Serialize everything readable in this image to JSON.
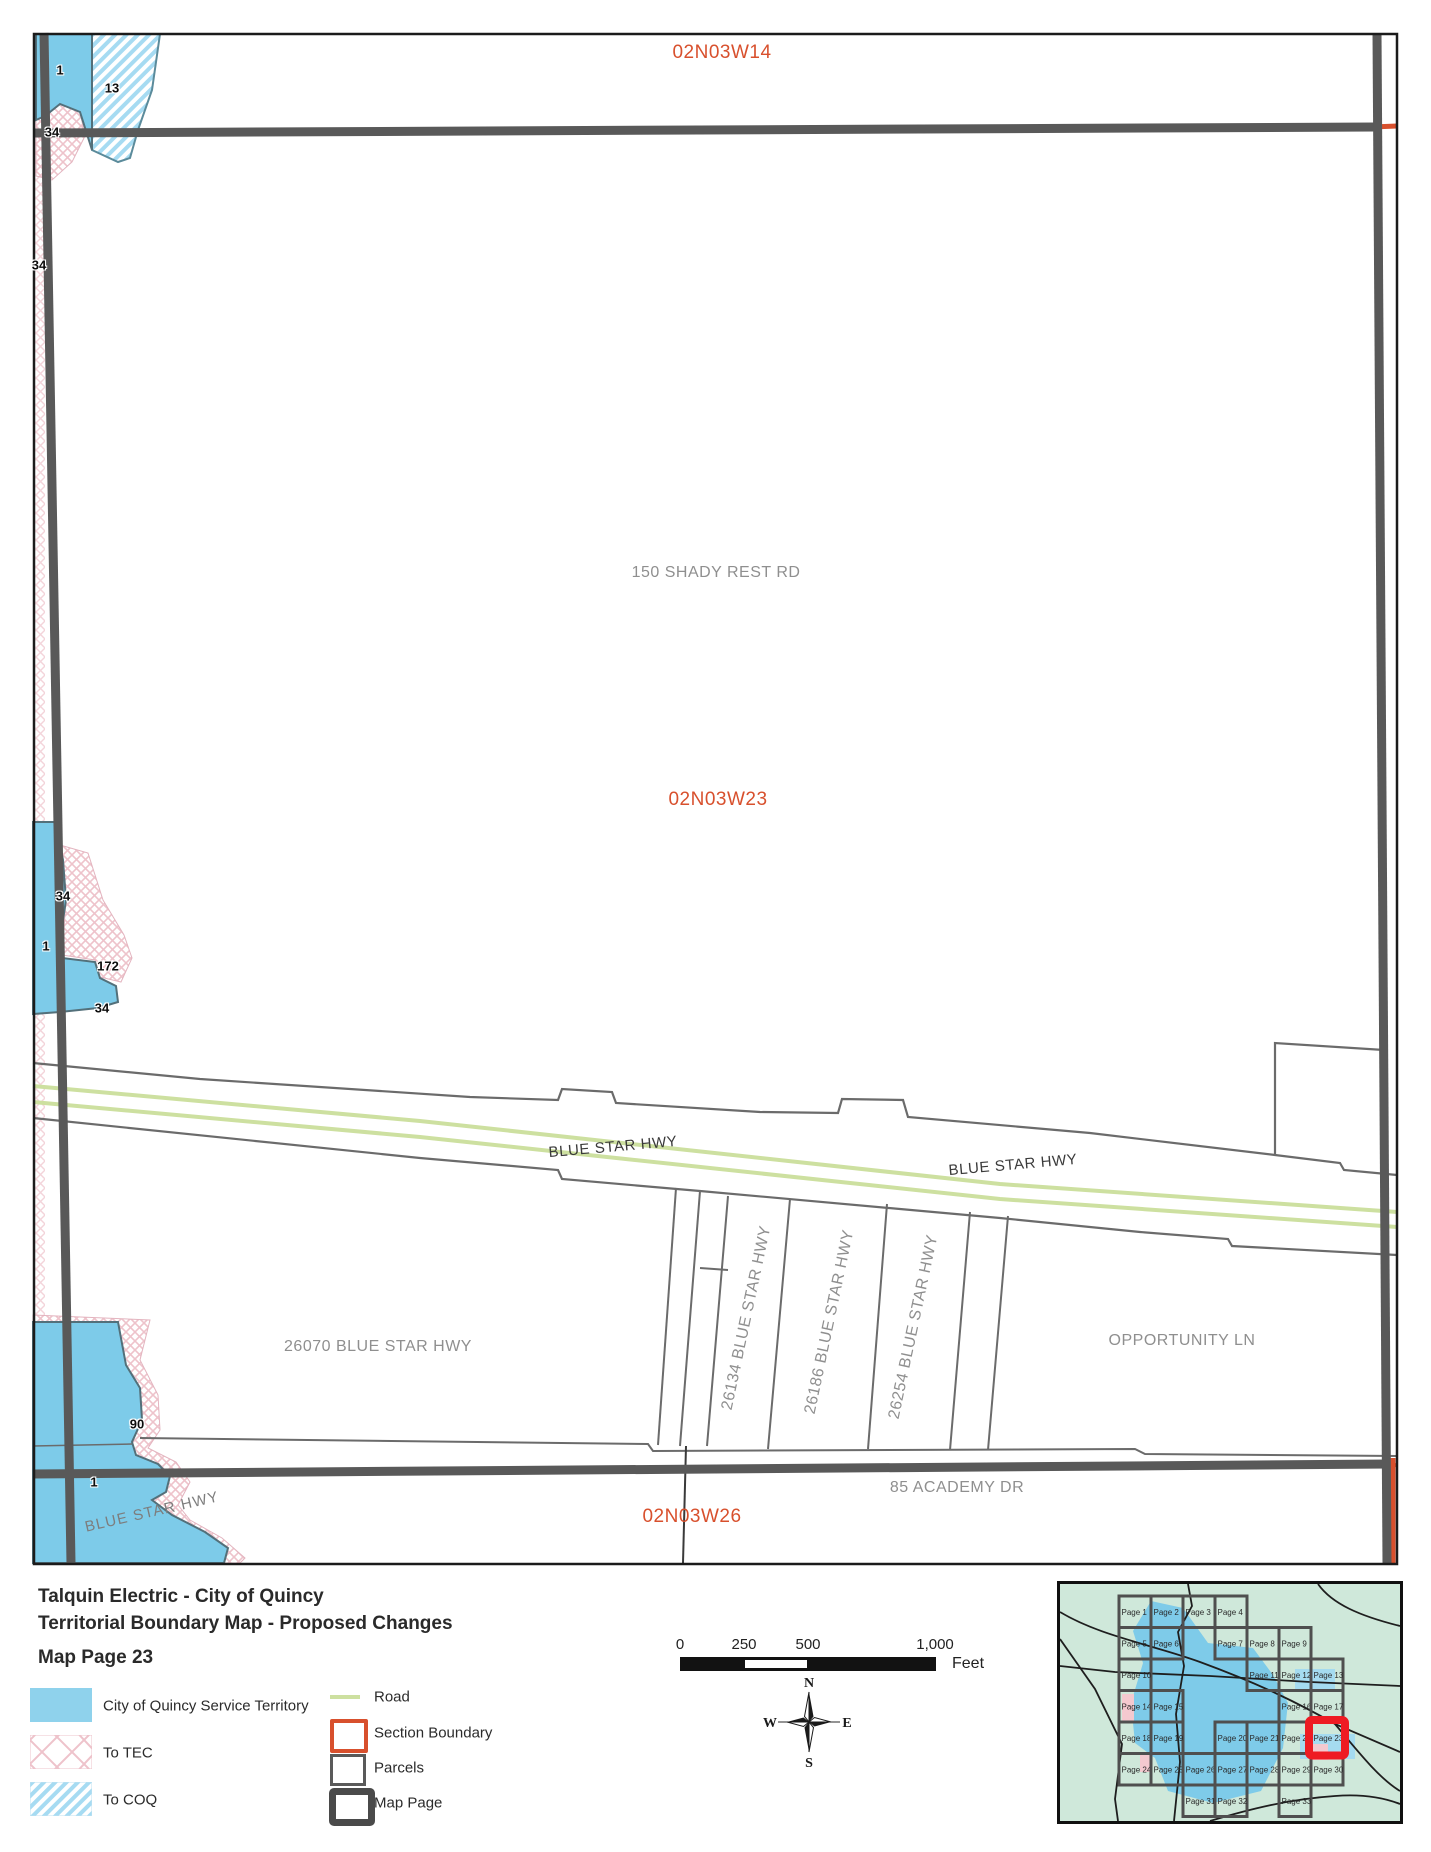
{
  "map": {
    "labels": [
      {
        "text": "02N03W14",
        "x": 722,
        "y": 53,
        "cls": "section",
        "rot": 0
      },
      {
        "text": "02N03W23",
        "x": 718,
        "y": 800,
        "cls": "section",
        "rot": 0
      },
      {
        "text": "02N03W26",
        "x": 692,
        "y": 1517,
        "cls": "section",
        "rot": 0
      },
      {
        "text": "150 SHADY REST RD",
        "x": 716,
        "y": 573,
        "cls": "address",
        "rot": 0
      },
      {
        "text": "26070 BLUE STAR HWY",
        "x": 378,
        "y": 1347,
        "cls": "address",
        "rot": 0
      },
      {
        "text": "OPPORTUNITY LN",
        "x": 1182,
        "y": 1341,
        "cls": "address",
        "rot": 0
      },
      {
        "text": "85 ACADEMY DR",
        "x": 957,
        "y": 1488,
        "cls": "address",
        "rot": 0
      },
      {
        "text": "BLUE STAR HWY",
        "x": 613,
        "y": 1147,
        "cls": "road-dark",
        "rot": -5
      },
      {
        "text": "BLUE STAR HWY",
        "x": 1013,
        "y": 1165,
        "cls": "road-dark",
        "rot": -5
      },
      {
        "text": "BLUE STAR HWY",
        "x": 152,
        "y": 1512,
        "cls": "road-gray",
        "rot": -13
      },
      {
        "text": "26134 BLUE STAR HWY",
        "x": 747,
        "y": 1318,
        "cls": "address",
        "rot": -78
      },
      {
        "text": "26186 BLUE STAR HWY",
        "x": 830,
        "y": 1322,
        "cls": "address",
        "rot": -78
      },
      {
        "text": "26254 BLUE STAR HWY",
        "x": 914,
        "y": 1327,
        "cls": "address",
        "rot": -78
      },
      {
        "text": "1",
        "x": 60,
        "y": 70,
        "cls": "num",
        "rot": 0
      },
      {
        "text": "13",
        "x": 112,
        "y": 88,
        "cls": "num",
        "rot": 0
      },
      {
        "text": "34",
        "x": 52,
        "y": 132,
        "cls": "num",
        "rot": 0
      },
      {
        "text": "34",
        "x": 39,
        "y": 265,
        "cls": "num",
        "rot": 0
      },
      {
        "text": "34",
        "x": 63,
        "y": 896,
        "cls": "num",
        "rot": 0
      },
      {
        "text": "1",
        "x": 46,
        "y": 946,
        "cls": "num",
        "rot": 0
      },
      {
        "text": "172",
        "x": 108,
        "y": 966,
        "cls": "num",
        "rot": 0
      },
      {
        "text": "34",
        "x": 102,
        "y": 1008,
        "cls": "num",
        "rot": 0
      },
      {
        "text": "90",
        "x": 137,
        "y": 1424,
        "cls": "num",
        "rot": 0
      },
      {
        "text": "1",
        "x": 94,
        "y": 1482,
        "cls": "num",
        "rot": 0
      }
    ]
  },
  "footer": {
    "title_line1": "Talquin Electric - City of Quincy",
    "title_line2": "Territorial Boundary Map - Proposed Changes",
    "title_line3": "Map Page 23",
    "legend_left": [
      {
        "label": "City of Quincy Service Territory",
        "swatch": "solid-blue"
      },
      {
        "label": "To TEC",
        "swatch": "pink-crosshatch"
      },
      {
        "label": "To COQ",
        "swatch": "blue-diagonal"
      }
    ],
    "legend_right": [
      {
        "label": "Road",
        "swatch": "road-line"
      },
      {
        "label": "Section Boundary",
        "swatch": "red-outline"
      },
      {
        "label": "Parcels",
        "swatch": "gray-outline"
      },
      {
        "label": "Map Page",
        "swatch": "thick-gray-outline"
      }
    ],
    "scale_bar": {
      "ticks": [
        {
          "label": "0",
          "x": 680
        },
        {
          "label": "250",
          "x": 744
        },
        {
          "label": "500",
          "x": 808
        },
        {
          "label": "1,000",
          "x": 935
        }
      ],
      "unit": "Feet"
    },
    "compass": {
      "n": "N",
      "s": "S",
      "e": "E",
      "w": "W"
    }
  },
  "inset": {
    "highlighted_page": "Page 23",
    "pages": [
      {
        "label": "Page 1",
        "col": 1,
        "row": 1
      },
      {
        "label": "Page 2",
        "col": 2,
        "row": 1
      },
      {
        "label": "Page 3",
        "col": 3,
        "row": 1
      },
      {
        "label": "Page 4",
        "col": 4,
        "row": 1
      },
      {
        "label": "Page 5",
        "col": 1,
        "row": 2
      },
      {
        "label": "Page 6",
        "col": 2,
        "row": 2
      },
      {
        "label": "Page 7",
        "col": 4,
        "row": 2
      },
      {
        "label": "Page 8",
        "col": 5,
        "row": 2
      },
      {
        "label": "Page 9",
        "col": 6,
        "row": 2
      },
      {
        "label": "Page 10",
        "col": 1,
        "row": 3
      },
      {
        "label": "Page 11",
        "col": 5,
        "row": 3
      },
      {
        "label": "Page 12",
        "col": 6,
        "row": 3
      },
      {
        "label": "Page 13",
        "col": 7,
        "row": 3
      },
      {
        "label": "Page 14",
        "col": 1,
        "row": 4
      },
      {
        "label": "Page 15",
        "col": 2,
        "row": 4
      },
      {
        "label": "Page 16",
        "col": 6,
        "row": 4
      },
      {
        "label": "Page 17",
        "col": 7,
        "row": 4
      },
      {
        "label": "Page 18",
        "col": 1,
        "row": 5
      },
      {
        "label": "Page 19",
        "col": 2,
        "row": 5
      },
      {
        "label": "Page 20",
        "col": 4,
        "row": 5
      },
      {
        "label": "Page 21",
        "col": 5,
        "row": 5
      },
      {
        "label": "Page 22",
        "col": 6,
        "row": 5
      },
      {
        "label": "Page 23",
        "col": 7,
        "row": 5
      },
      {
        "label": "Page 24",
        "col": 1,
        "row": 6
      },
      {
        "label": "Page 25",
        "col": 2,
        "row": 6
      },
      {
        "label": "Page 26",
        "col": 3,
        "row": 6
      },
      {
        "label": "Page 27",
        "col": 4,
        "row": 6
      },
      {
        "label": "Page 28",
        "col": 5,
        "row": 6
      },
      {
        "label": "Page 29",
        "col": 6,
        "row": 6
      },
      {
        "label": "Page 30",
        "col": 7,
        "row": 6
      },
      {
        "label": "Page 31",
        "col": 3,
        "row": 7
      },
      {
        "label": "Page 32",
        "col": 4,
        "row": 7
      },
      {
        "label": "Page 33",
        "col": 6,
        "row": 7
      }
    ]
  },
  "colors": {
    "section_label": "#d8502d",
    "territory_blue": "#7dcbe9",
    "road_green": "#cde0a0",
    "map_page_gray": "#595959",
    "inset_background": "#cfe8da",
    "highlight_red": "#ee1b23"
  }
}
